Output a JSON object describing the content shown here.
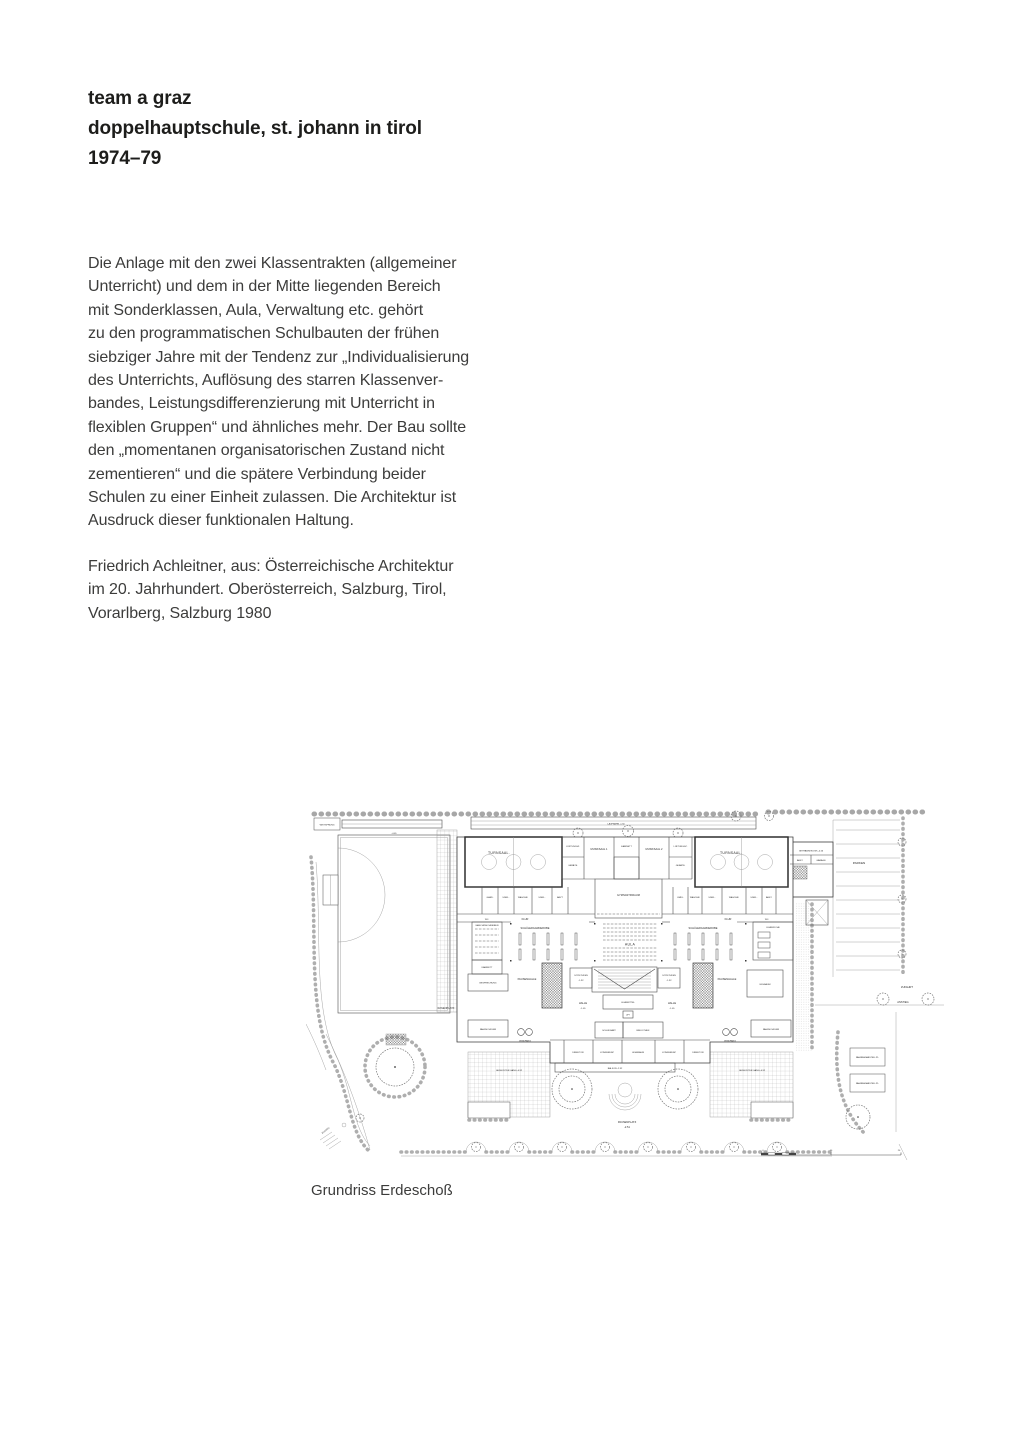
{
  "page": {
    "title_line1": "team a graz",
    "title_line2": "doppelhauptschule, st. johann in tirol",
    "title_line3": "1974–79"
  },
  "body": {
    "text": "Die Anlage mit den zwei Klassentrakten (allgemeiner\nUnterricht) und dem in der Mitte liegenden Bereich\nmit Sonderklassen, Aula, Verwaltung etc. gehört\nzu den programmatischen Schulbauten der frühen\nsiebziger Jahre mit der Tendenz zur „Individualisierung\ndes Unterrichts, Auflösung des starren Klassenver-\nbandes, Leistungsdifferenzierung mit Unterricht in\nflexiblen Gruppen“ und ähnliches mehr. Der Bau sollte\nden „momentanen organisatorischen Zustand nicht\nzementieren“ und die spätere Verbindung beider\nSchulen zu einer Einheit zulassen. Die Architektur ist\nAusdruck dieser funktionalen Haltung."
  },
  "citation": {
    "text": "Friedrich Achleitner, aus: Österreichische Architektur\nim 20. Jahrhundert. Oberösterreich, Salzburg, Tirol,\nVorarlberg, Salzburg 1980"
  },
  "figure": {
    "caption": "Grundriss Erdeschoß"
  },
  "plan": {
    "labels": {
      "weitsprung": "WEITSPRUNG",
      "laufbahn": "LAUFBAHN   -1.50",
      "level_405": "-4.05",
      "rasenplatz": "RASENPLATZ",
      "turnsaal": "TURNSAAL.",
      "lueftung": "LÜFTUNGSZ.",
      "geraete": "GERÄTE.",
      "musiksaal1": "MUSIKSAAL 1",
      "kabinett": "KABINETT",
      "musiksaal2": "MUSIKSAAL 2",
      "gymnastikraum": "GYMNASTIKRAUM",
      "wc": "WC.",
      "flur": "FLUR",
      "maschinschreiben": "MASCHINSCHREIBEN",
      "schuelergarderobe": "SCHÜLERGARDEROBE",
      "aula": "AULA",
      "lehrkueche": "LEHRKÜCHE",
      "besprechung": "BESPRECHUNG",
      "pausenhalle": "PAUSENHALLE",
      "sitzstufen": "SITZSTUFEN",
      "level_192": "-1.92",
      "lehrmittel": "LEHRMITTEL",
      "lift": "LIFT",
      "halle": "HALLE",
      "level_105": "-1.05",
      "essraum": "ESSRAUM",
      "fahrschueler": "FAHRSCHÜLER",
      "windfang": "WINDFANG",
      "schulwart": "SCHULWART",
      "bibliothek": "BIBLIOTHEK",
      "direktor": "DIREKTOR",
      "konferenz": "KONFERENZ",
      "leseraum": "LESERAUM",
      "balkon": "BALKON   -2.32",
      "gedeckter_gang": "GEDECKTER GANG  -0.92",
      "pausenplatz": "PAUSENPLATZ",
      "level_251": "-2.51",
      "parken": "PARKEN",
      "getraenkekiosk": "GETRÄNKEKIOSK  -0.56",
      "abst": "ABST.",
      "garage": "GARAGE",
      "zufahrt": "ZUFAHRT",
      "anstieg": "ANSTIEG",
      "fahrrad": "FAHRRADABSTELLPL.",
      "zugang": "ZUGANG"
    },
    "rooms_left": [
      "GARD.",
      "UMKL.",
      "WASCHR.",
      "UMKL.",
      "ARZT"
    ],
    "rooms_right": [
      "UMKL.",
      "WASCHR.",
      "UMKL.",
      "WASCHR.",
      "UMKL.",
      "ABST."
    ],
    "scale": {
      "s0": "0",
      "s10": "10",
      "s20": "20"
    }
  }
}
